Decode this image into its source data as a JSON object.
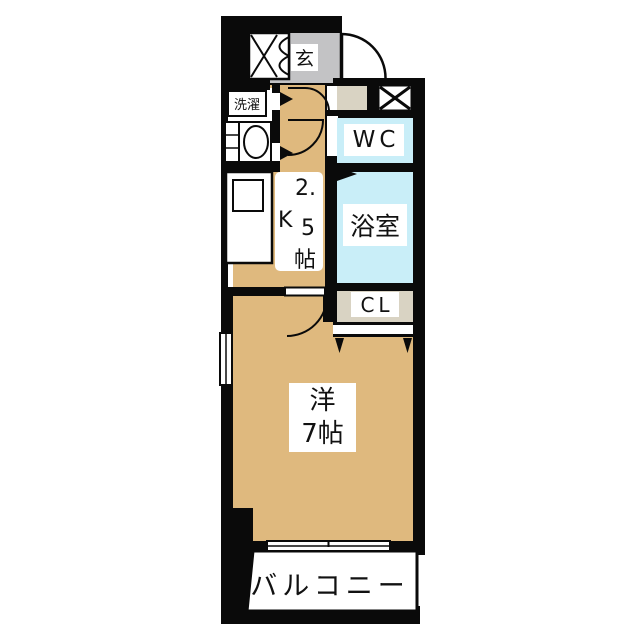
{
  "floorplan": {
    "rooms": {
      "genkan": {
        "label": "玄"
      },
      "laundry": {
        "label": "洗濯"
      },
      "wc": {
        "label": "WC"
      },
      "bath": {
        "label": "浴室"
      },
      "kitchen": {
        "parts": [
          "2.",
          "K",
          "5",
          "帖"
        ]
      },
      "closet": {
        "label": "CL"
      },
      "western_room": {
        "lines": [
          "洋",
          "7帖"
        ]
      },
      "balcony": {
        "label": "バルコニー"
      }
    },
    "colors": {
      "floor_tan": "#DFB97E",
      "water_cyan": "#C9EEF8",
      "entry_gray": "#C3C3C5",
      "closet_beige": "#D9D3C3",
      "wall_black": "#0A0A0A"
    }
  }
}
